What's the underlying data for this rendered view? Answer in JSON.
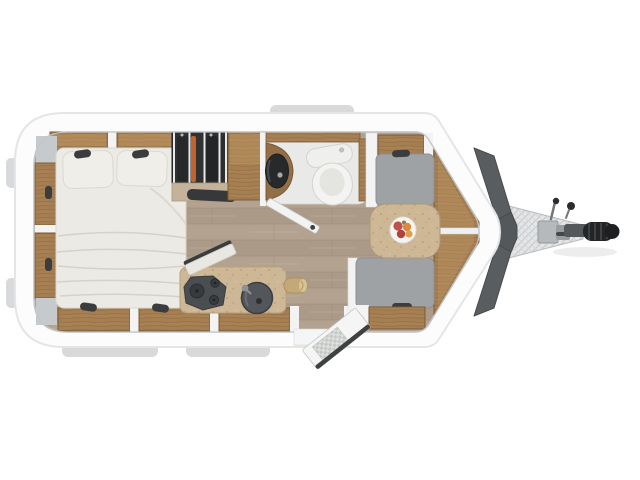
{
  "meta": {
    "type": "floorplan",
    "subject": "caravan-travel-trailer",
    "view": "top-down",
    "hitch_direction": "right"
  },
  "rooms": {
    "bedroom": {
      "name": "rear-bedroom",
      "features": [
        "double-bed",
        "two-pillows",
        "overhead-lockers",
        "reading-lights",
        "side-cabinets",
        "corner-shelves"
      ]
    },
    "wardrobe": {
      "name": "wardrobe",
      "features": [
        "hanging-clothes",
        "lower-console",
        "dark-bench"
      ]
    },
    "bathroom": {
      "name": "bathroom",
      "features": [
        "toilet",
        "corner-washbasin",
        "wood-vanity",
        "open-door"
      ]
    },
    "kitchen": {
      "name": "kitchen",
      "features": [
        "three-burner-hob",
        "round-sink",
        "worktop",
        "base-cabinets",
        "rolled-table-leaf",
        "folding-flap"
      ]
    },
    "dinette": {
      "name": "front-dinette",
      "features": [
        "front-bench-seat",
        "rear-bench-seat",
        "table",
        "fruit-plate",
        "front-chest"
      ]
    },
    "exterior": {
      "name": "exterior",
      "features": [
        "entry-door-open",
        "door-step",
        "a-frame-drawbar",
        "hitch-coupling",
        "hitch-grip",
        "jockey-crank-handles",
        "front-skirt-panels",
        "roof-tab",
        "bumper-tabs",
        "side-tabs"
      ]
    }
  },
  "colors": {
    "background": "#ffffff",
    "shell": "#fcfcfd",
    "shell_edge": "#e3e5e7",
    "wall": "#c3c6c8",
    "divider": "#f2f3f2",
    "tab": "#d7d9db",
    "wood": "#a57e51",
    "wood_edge": "#7c5a35",
    "wood_light": "#c09a66",
    "floor_light": "#b3a28f",
    "floor_dark": "#ab9a87",
    "floor_seam": "#9b8a78",
    "shelf_light": "#c4b29b",
    "bed": "#eceae5",
    "bed_line": "#d6d2ca",
    "pillow": "#f0eee9",
    "cushion": "#9ea2a5",
    "cushion_edge": "#8d9093",
    "wardrobe_dark": "#2e3032",
    "clothes_orange": "#c4622c",
    "garment_dark": "#26282a",
    "bath_floor": "#e9eae8",
    "toilet_white": "#f3f4f1",
    "basin_dark": "#27292b",
    "hob": "#4b4e51",
    "sink": "#53565a",
    "fixture_dark": "#3a3c3e",
    "nose_panel": "#5a5d60",
    "metal": "#b6b9bc",
    "grip": "#222426",
    "knob": "#2a2c2e",
    "counter": "#cdb795",
    "speckle": "#b7a183",
    "fruit_red": "#c0504a",
    "fruit_red2": "#b2423e",
    "fruit_orange": "#d98a3f",
    "fruit_orange2": "#dda04e",
    "leaf_green": "#7a8450",
    "door_edge": "#3e4042",
    "gray_shelf": "#c7cacc"
  }
}
